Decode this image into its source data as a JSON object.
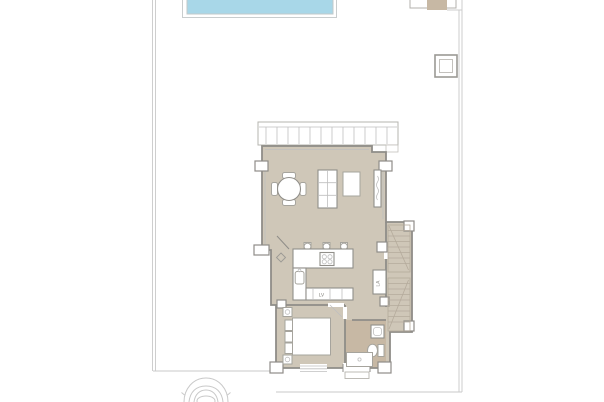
{
  "floor_plan": {
    "appliance_labels": {
      "dishwasher": "LV",
      "washing_machine": "LA"
    },
    "colors": {
      "background": "#ffffff",
      "pool_water": "#a8d7e8",
      "pool_edge": "#c9cdce",
      "floor": "#cfc7b8",
      "floor_dark": "#c7b8a4",
      "wall": "#8f8d88",
      "line_light": "#c9c9c9",
      "furniture_stroke": "#a6a49d",
      "tread": "#b5ab9c",
      "car_line": "#c9c9c9"
    }
  }
}
